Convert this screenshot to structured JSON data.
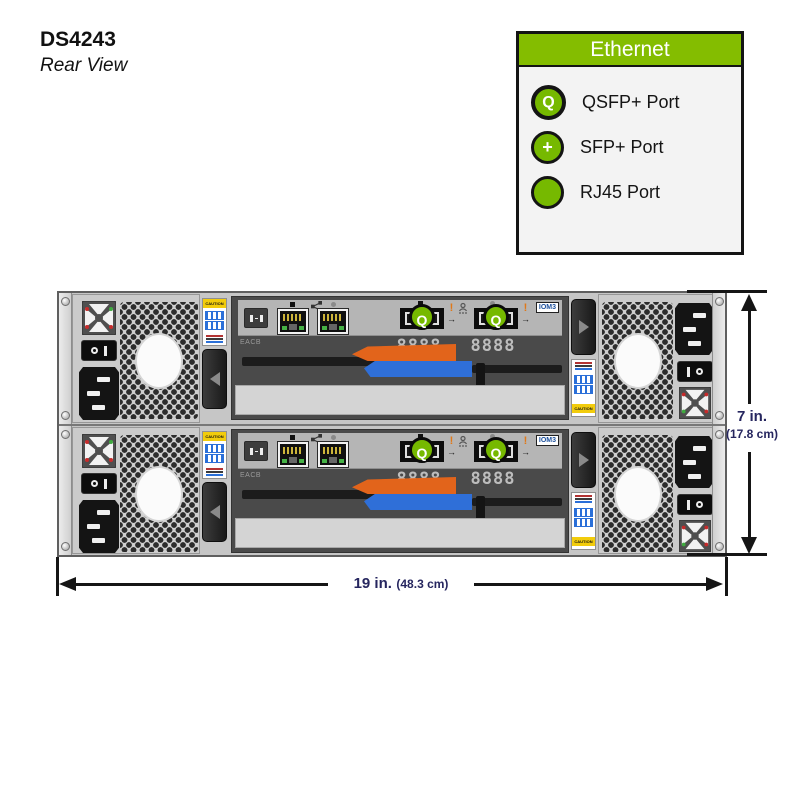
{
  "page": {
    "title_model": "DS4243",
    "title_view": "Rear View"
  },
  "legend": {
    "header": "Ethernet",
    "items": [
      {
        "icon": "qsfp-circle-icon",
        "glyph": "Q",
        "label": "QSFP+ Port"
      },
      {
        "icon": "sfp-circle-icon",
        "glyph": "+",
        "label": "SFP+ Port"
      },
      {
        "icon": "rj45-circle-icon",
        "glyph": "",
        "label": "RJ45 Port"
      }
    ]
  },
  "dimensions": {
    "height_main": "7 in.",
    "height_sub": "(17.8 cm)",
    "width_main": "19 in.",
    "width_sub": "(48.3 cm)"
  },
  "shelf": {
    "iom_badge": "IOM3",
    "iom_left_label": "EACB",
    "port_pins": "8888",
    "caution_text": "CAUTION",
    "qsfp_glyph": "Q",
    "excl": "!",
    "arrow": "→"
  },
  "colors": {
    "legend_green": "#84bd00",
    "port_green": "#76b900",
    "lever_orange": "#e2641b",
    "lever_blue": "#2f6fd8",
    "caution_yellow": "#f2cc0c",
    "label_blue": "#2a6fd8",
    "dim_text": "#26265f"
  }
}
